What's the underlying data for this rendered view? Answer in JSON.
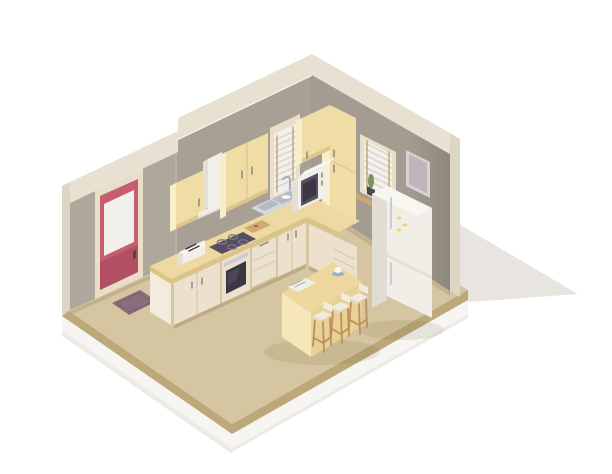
{
  "scene": {
    "title": "Isometric low-poly kitchen interior cutaway illustration",
    "room": {
      "left_wall": "wall with red entrance door and window over sink",
      "right_wall": "wall with window, picture frame and fridge",
      "floor": "tan floor slab floating on white background with cast shadow"
    },
    "objects": [
      {
        "name": "entrance-door",
        "label": "Red door with glass panel"
      },
      {
        "name": "doormat",
        "label": "Dark mauve doormat"
      },
      {
        "name": "wall-cabinet-a",
        "label": "Single wall cabinet"
      },
      {
        "name": "range-hood",
        "label": "Extractor hood with duct"
      },
      {
        "name": "wall-cabinet-b",
        "label": "Double wall cabinet"
      },
      {
        "name": "window-left",
        "label": "Window with white blinds over sink"
      },
      {
        "name": "wall-cabinet-c",
        "label": "Corner wall cabinet"
      },
      {
        "name": "tall-cabinet",
        "label": "Tall corner cabinet"
      },
      {
        "name": "microwave",
        "label": "Microwave oven on counter"
      },
      {
        "name": "toaster",
        "label": "Toaster on counter"
      },
      {
        "name": "cooktop",
        "label": "Four-burner cooktop"
      },
      {
        "name": "oven",
        "label": "Built-in oven"
      },
      {
        "name": "sink",
        "label": "Double-bowl sink with faucet"
      },
      {
        "name": "counter",
        "label": "L-shaped counter with base cabinets and drawers"
      },
      {
        "name": "window-right",
        "label": "Window with white blinds and cactus"
      },
      {
        "name": "picture-frame",
        "label": "Framed picture"
      },
      {
        "name": "fridge",
        "label": "Two-door fridge with yellow magnets"
      },
      {
        "name": "island",
        "label": "Kitchen island with cup and newspaper"
      },
      {
        "name": "bar-stools",
        "label": "Three bar stools"
      }
    ]
  },
  "colors": {
    "bg": "#ffffff",
    "cast_shadow": "#e8e5e1",
    "slab_side": "#f7f5f1",
    "slab_shadow": "#eeebe6",
    "floor_top": "#d5c5a0",
    "floor_edge": "#bca878",
    "wall_left": "#a8a095",
    "wall_left_near": "#aea79b",
    "wall_right": "#a49c91",
    "wall_right_dark": "#8e877b",
    "wall_top_band": "#e8e1d1",
    "wall_cut_edge": "#ded6c5",
    "wall_base_strip": "#b3a17a",
    "wall_step_line": "#bdb5a9",
    "corner_line": "#8f8a80",
    "door_frame": "#e9dfc9",
    "door_red": "#c75d70",
    "door_red_dark": "#b24f62",
    "door_glass": "#f2f0ea",
    "door_handle": "#4f483f",
    "mat": "#8a6d7d",
    "mat_dark": "#7b5f6f",
    "cab_front": "#f0dda6",
    "cab_side": "#f8eecb",
    "cab_shade": "#ddc68c",
    "cab_handle": "#958c77",
    "hood_white": "#f2efe9",
    "hood_side": "#e4e0d6",
    "counter_top": "#eed9a2",
    "counter_edge": "#dcc488",
    "base_front": "#ebe1cd",
    "base_side": "#f3ebdb",
    "base_seam": "#d6c9b0",
    "base_kick": "#b2a078",
    "oven_dark": "#3c3744",
    "oven_glass_hl": "#575164",
    "steel": "#c9ccd2",
    "steel_dark": "#a8adb5",
    "cooktop": "#574e60",
    "burner": "#7d7389",
    "sink_rim": "#d4d7db",
    "sink_basin": "#b6bac1",
    "blind_white": "#f1f0ec",
    "blind_slat": "#d8d3c9",
    "blind_cord": "#c2a06b",
    "sill_wood": "#cfa96f",
    "frame_outer": "#dad1d3",
    "frame_inner": "#c3b4bb",
    "fridge_front": "#f1eee7",
    "fridge_side": "#e2ddd2",
    "fridge_top": "#f8f6f1",
    "magnet_yellow": "#f2d469",
    "island_top": "#edd79e",
    "island_front": "#f5e7ba",
    "island_side": "#e7d196",
    "stool_seat": "#f1ebdf",
    "stool_seat_side": "#e2dccd",
    "stool_wood": "#bf8f58",
    "paper": "#f0eee8",
    "paper_line": "#b6b2a9",
    "saucer_blue": "#8fb4d4",
    "cup_white": "#fbfaf7",
    "plant_pot": "#4e4a45",
    "plant_green": "#7c9158",
    "shadow_soft": "rgba(110,95,60,0.12)"
  }
}
